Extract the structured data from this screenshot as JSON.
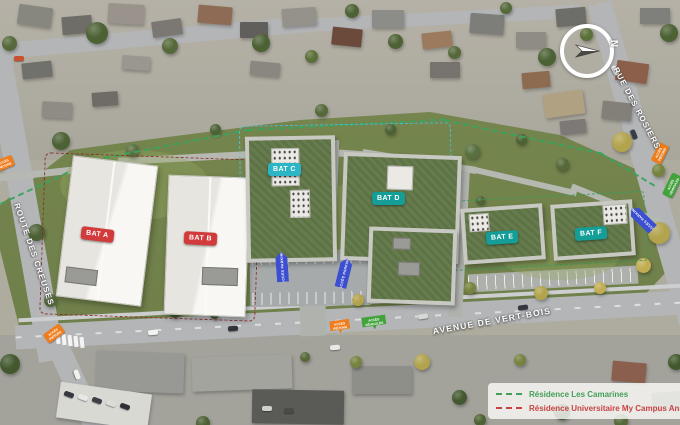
{
  "plan": {
    "buildings": [
      {
        "id": "bat-a",
        "label": "BAT A",
        "badge_color": "#d23b3b"
      },
      {
        "id": "bat-b",
        "label": "BAT B",
        "badge_color": "#d23b3b"
      },
      {
        "id": "bat-c",
        "label": "BAT C",
        "badge_color": "#2cb5c4"
      },
      {
        "id": "bat-d",
        "label": "BAT D",
        "badge_color": "#159e97"
      },
      {
        "id": "bat-e",
        "label": "BAT E",
        "badge_color": "#159e97"
      },
      {
        "id": "bat-f",
        "label": "BAT F",
        "badge_color": "#159e97"
      }
    ],
    "streets": [
      {
        "id": "route-des-creuses",
        "label": "ROUTE DES CREUSES"
      },
      {
        "id": "rue-des-rosiers",
        "label": "RUE DES ROSIERS"
      },
      {
        "id": "avenue-de-vert-bois",
        "label": "AVENUE DE VERT-BOIS"
      }
    ],
    "compass": {
      "label": "N"
    },
    "access_tags": {
      "pedestrian": {
        "line1": "ACCÈS",
        "line2": "PIÉTONS",
        "color": "#ee7d1d"
      },
      "vehicle": {
        "line1": "ACCÈS",
        "line2": "VÉHICULES",
        "color": "#43a23c"
      }
    },
    "parking_sign": {
      "label": "ACCÈS PARKING",
      "color": "#3b4fd0"
    },
    "legend": {
      "items": [
        {
          "label": "Résidence Les Camarines",
          "color": "#43a058"
        },
        {
          "label": "Résidence Universitaire My Campus Ann",
          "color": "#c74343"
        }
      ]
    }
  }
}
